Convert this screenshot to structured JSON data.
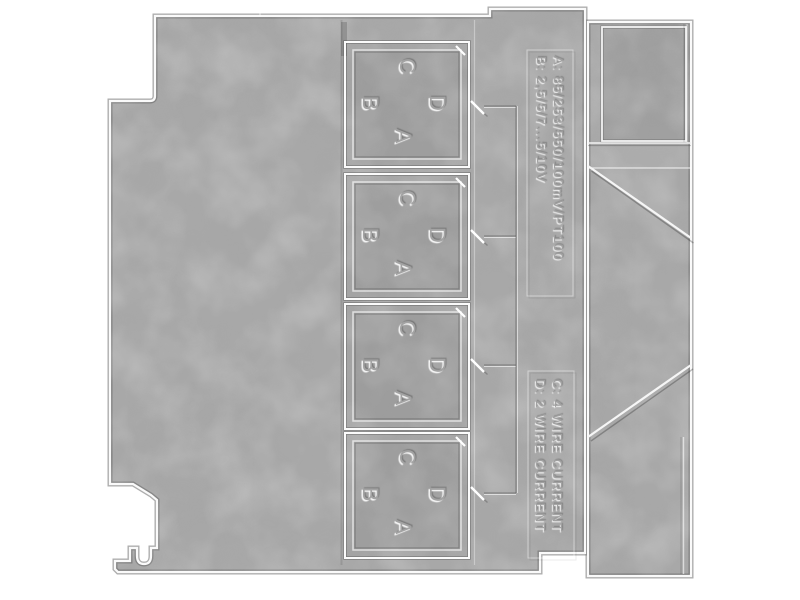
{
  "colors": {
    "background": "#ffffff",
    "panel_gray": "#a7a7a7",
    "edge_highlight": "#fafafa",
    "groove_shadow": "#5f5f5f"
  },
  "side_label_top": {
    "line_a": "A: 85/253/550/100mV/PT100",
    "line_b": "B: 2,5/5/7...5/10V"
  },
  "side_label_bottom": {
    "line_c": "C: 4 WIRE CURRENT",
    "line_d": "D: 2 WIRE CURRENT"
  },
  "windows": [
    {
      "top": "C",
      "left": "B",
      "right": "D",
      "bottom": "A"
    },
    {
      "top": "C",
      "left": "B",
      "right": "D",
      "bottom": "A"
    },
    {
      "top": "C",
      "left": "B",
      "right": "D",
      "bottom": "A"
    },
    {
      "top": "C",
      "left": "B",
      "right": "D",
      "bottom": "A"
    }
  ]
}
